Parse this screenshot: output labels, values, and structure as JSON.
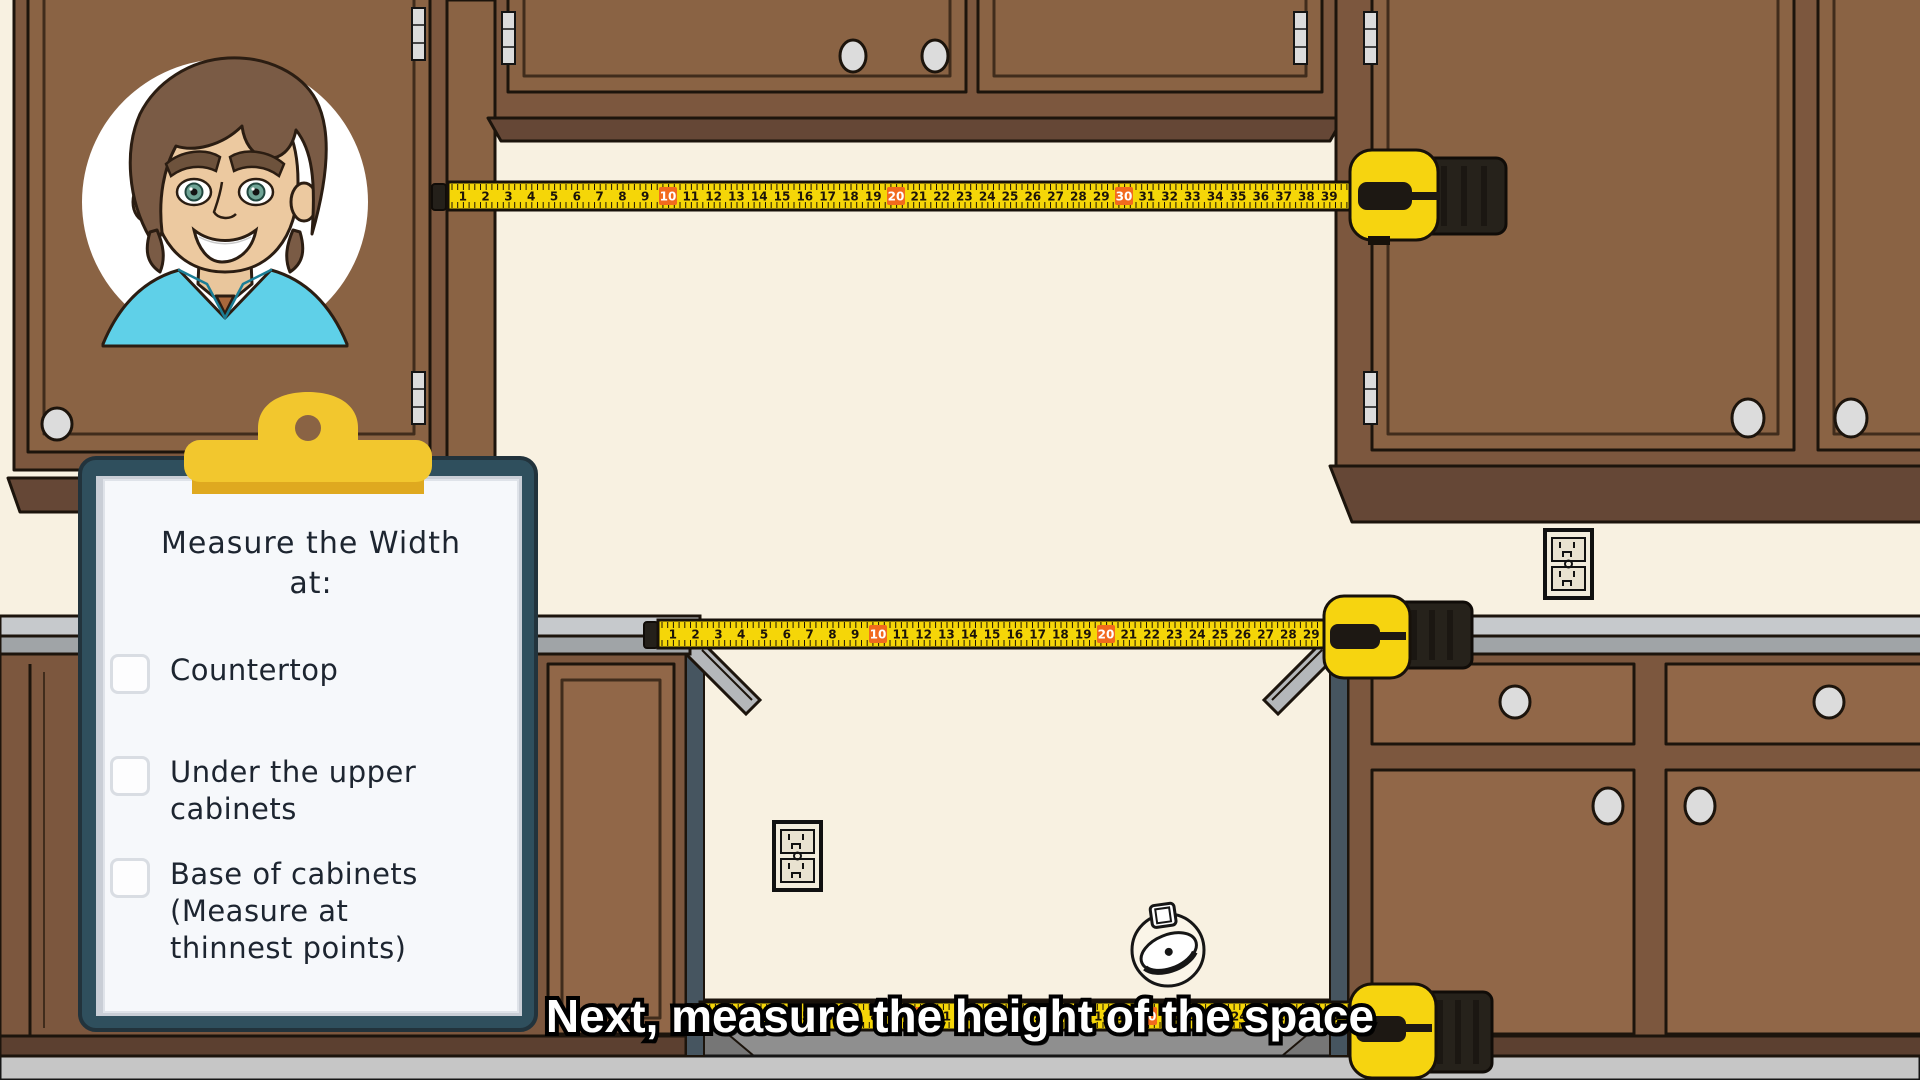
{
  "scene_title": "kitchen measuring tutorial frame",
  "caption": {
    "text": "Next, measure the height of the space"
  },
  "clipboard": {
    "title": "Measure the Width\nat:",
    "items": [
      {
        "text": "Countertop",
        "checked": false
      },
      {
        "text": "Under the upper\ncabinets",
        "checked": false
      },
      {
        "text": "Base of cabinets\n(Measure at\nthinnest points)",
        "checked": false
      }
    ]
  },
  "tape_measures": {
    "highlight_every": 10,
    "upper": {
      "first_number": 1,
      "last_number": 39
    },
    "countertop": {
      "first_number": 1,
      "last_number": 29
    },
    "bottom": {
      "first_number": 1,
      "last_number": 28
    }
  },
  "icons": {
    "doodle": "tape-measure-doodle",
    "outlet": "duplex-power-outlet",
    "knob": "cabinet-knob",
    "hinge": "cabinet-hinge",
    "avatar": "presenter-cartoon-avatar"
  },
  "colors": {
    "wall": "#f8f1e1",
    "floor": "#c6c6c6",
    "cabinet_face": "#8a6344",
    "cabinet_frame": "#7c573e",
    "cabinet_panel_light": "#916748",
    "molding": "#654736",
    "toe_kick": "#5c4030",
    "counter_light": "#c6c9cc",
    "counter_mid": "#a0a4a7",
    "gap_shadow": "#8f8f8f",
    "slate_edge": "#465560",
    "tape_yellow": "#f5d608",
    "tape_case_yellow": "#f6d410",
    "tape_case_black": "#26221b",
    "tape_highlight_orange": "#f26a1e",
    "clipboard_teal": "#2f4f5d",
    "clip_yellow": "#f2c72e",
    "paper": "#f6f8fb",
    "caption_fill": "#ffffff",
    "caption_stroke": "#000000"
  }
}
